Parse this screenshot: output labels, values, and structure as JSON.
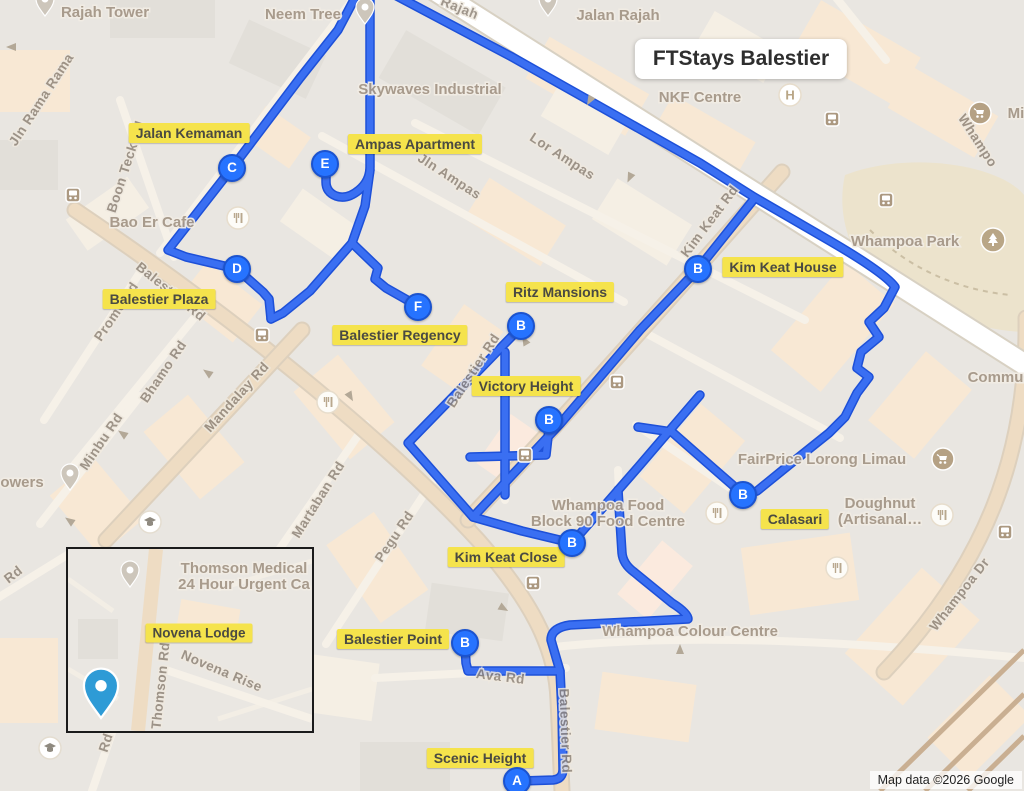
{
  "title": "FTStays Balestier",
  "attribution": "Map data ©2026 Google",
  "colors": {
    "route_core": "#3a6ff2",
    "route_casing": "#1d50d8",
    "marker_fill": "#2673ff",
    "marker_ring": "#1b53cf",
    "label_bg": "#f5e34c",
    "map_bg": "#e9e6e1"
  },
  "map": {
    "property_labels": [
      {
        "text": "Jalan Kemaman",
        "x": 189,
        "y": 133
      },
      {
        "text": "Ampas Apartment",
        "x": 415,
        "y": 144
      },
      {
        "text": "Kim Keat House",
        "x": 783,
        "y": 267
      },
      {
        "text": "Balestier Plaza",
        "x": 159,
        "y": 299
      },
      {
        "text": "Ritz Mansions",
        "x": 560,
        "y": 292
      },
      {
        "text": "Balestier Regency",
        "x": 400,
        "y": 335
      },
      {
        "text": "Victory Height",
        "x": 526,
        "y": 386
      },
      {
        "text": "Calasari",
        "x": 795,
        "y": 519
      },
      {
        "text": "Kim Keat Close",
        "x": 506,
        "y": 557
      },
      {
        "text": "Balestier Point",
        "x": 393,
        "y": 639
      },
      {
        "text": "Scenic Height",
        "x": 480,
        "y": 758
      }
    ],
    "markers": [
      {
        "letter": "C",
        "x": 232,
        "y": 168
      },
      {
        "letter": "E",
        "x": 325,
        "y": 164
      },
      {
        "letter": "D",
        "x": 237,
        "y": 269
      },
      {
        "letter": "F",
        "x": 418,
        "y": 307
      },
      {
        "letter": "B",
        "x": 521,
        "y": 326
      },
      {
        "letter": "B",
        "x": 698,
        "y": 269
      },
      {
        "letter": "B",
        "x": 549,
        "y": 420
      },
      {
        "letter": "B",
        "x": 572,
        "y": 543
      },
      {
        "letter": "B",
        "x": 743,
        "y": 495
      },
      {
        "letter": "B",
        "x": 465,
        "y": 643
      },
      {
        "letter": "A",
        "x": 517,
        "y": 781
      }
    ],
    "poi_labels": [
      {
        "lines": [
          "Rajah Tower"
        ],
        "x": 105,
        "y": 17
      },
      {
        "lines": [
          "Neem Tree"
        ],
        "x": 303,
        "y": 19
      },
      {
        "lines": [
          "Jalan Rajah"
        ],
        "x": 618,
        "y": 20
      },
      {
        "lines": [
          "Skywaves Industrial"
        ],
        "x": 430,
        "y": 94
      },
      {
        "lines": [
          "NKF Centre"
        ],
        "x": 700,
        "y": 102
      },
      {
        "lines": [
          "Whampoa Park"
        ],
        "x": 905,
        "y": 246
      },
      {
        "lines": [
          "Bao Er Cafe"
        ],
        "x": 152,
        "y": 227
      },
      {
        "lines": [
          "FairPrice Lorong Limau"
        ],
        "x": 822,
        "y": 464
      },
      {
        "lines": [
          "Doughnut",
          "(Artisanal…"
        ],
        "x": 880,
        "y": 508
      },
      {
        "lines": [
          "Whampoa Food",
          "Block 90 Food Centre"
        ],
        "x": 608,
        "y": 510
      },
      {
        "lines": [
          "Whampoa Colour Centre"
        ],
        "x": 690,
        "y": 636
      },
      {
        "lines": [
          "owers"
        ],
        "x": 22,
        "y": 487
      },
      {
        "lines": [
          "Commu…"
        ],
        "x": 1003,
        "y": 382
      },
      {
        "lines": [
          "Mi"
        ],
        "x": 1016,
        "y": 118
      }
    ],
    "street_labels": [
      {
        "text": "Jln Rama Rama",
        "x": 45,
        "y": 102,
        "rot": -57
      },
      {
        "text": "Boon Teck Rd",
        "x": 130,
        "y": 168,
        "rot": -72
      },
      {
        "text": "Rajah",
        "x": 458,
        "y": 12,
        "rot": 22
      },
      {
        "text": "Jln Ampas",
        "x": 447,
        "y": 180,
        "rot": 33
      },
      {
        "text": "Lor Ampas",
        "x": 560,
        "y": 160,
        "rot": 33
      },
      {
        "text": "Kim Keat Rd",
        "x": 713,
        "y": 224,
        "rot": -53
      },
      {
        "text": "Whampo",
        "x": 974,
        "y": 143,
        "rot": 57
      },
      {
        "text": "Balestier Rd",
        "x": 168,
        "y": 295,
        "rot": 39
      },
      {
        "text": "Balestier Rd",
        "x": 477,
        "y": 373,
        "rot": -57
      },
      {
        "text": "Balestier Rd",
        "x": 561,
        "y": 731,
        "rot": 88
      },
      {
        "text": "Bhamo Rd",
        "x": 167,
        "y": 374,
        "rot": -56
      },
      {
        "text": "Prome Rd",
        "x": 120,
        "y": 314,
        "rot": -56
      },
      {
        "text": "Mandalay Rd",
        "x": 240,
        "y": 400,
        "rot": -48
      },
      {
        "text": "Minbu Rd",
        "x": 105,
        "y": 444,
        "rot": -56
      },
      {
        "text": "Martaban Rd",
        "x": 322,
        "y": 502,
        "rot": -58
      },
      {
        "text": "Pegu Rd",
        "x": 398,
        "y": 539,
        "rot": -56
      },
      {
        "text": "Ava Rd",
        "x": 500,
        "y": 681,
        "rot": 7
      },
      {
        "text": "Whampoa Dr",
        "x": 963,
        "y": 597,
        "rot": -52
      },
      {
        "text": "Rd",
        "x": 16,
        "y": 578,
        "rot": -38
      },
      {
        "text": "Rd",
        "x": 110,
        "y": 744,
        "rot": -72
      }
    ],
    "routes": [
      "M 370 -6 L 370 167 Q 370 181 359 190 Q 347 200 336 196 Q 326 192 326 182 L 326 173",
      "M 370 170 L 365 206 L 352 243 L 310 291 L 283 313 L 271 319",
      "M 271 319 L 269 299 L 263 292 L 237 269",
      "M 237 269 L 186 257 L 168 250 L 232 168 L 300 78 L 338 30 L 357 -6",
      "M 352 243 L 378 268 L 375 279 L 386 288 L 416 305",
      "M 393 -6 L 512 57 L 700 163 L 754 197 Q 790 218 830 241 Q 885 273 895 287 L 884 308 L 869 322 L 879 337 L 861 352 L 857 368 L 869 377 L 857 393 L 845 417 L 829 433 L 789 465 L 757 491 L 744 495",
      "M 744 495 L 713 468 L 672 432 L 638 427",
      "M 698 269 L 754 199",
      "M 698 269 L 640 330 L 560 424 L 473 517 L 522 531 L 572 543",
      "M 522 326 L 408 443 L 473 517",
      "M 505 352 L 505 495",
      "M 572 543 L 640 465 L 700 395",
      "M 470 457 L 546 455 L 549 428",
      "M 618 490 L 622 553 Q 623 564 634 572 L 672 603 Q 688 613 688 619 L 570 625 Q 551 628 551 640 L 560 671",
      "M 465 645 L 466 663 L 468 671 L 560 671 L 562 712 L 563 769 Q 563 779 553 780 L 521 781"
    ],
    "icons": [
      {
        "type": "bus",
        "x": 73,
        "y": 195
      },
      {
        "type": "bus",
        "x": 262,
        "y": 335
      },
      {
        "type": "bus",
        "x": 617,
        "y": 382
      },
      {
        "type": "bus",
        "x": 525,
        "y": 455
      },
      {
        "type": "bus",
        "x": 533,
        "y": 583
      },
      {
        "type": "bus",
        "x": 886,
        "y": 200
      },
      {
        "type": "bus",
        "x": 832,
        "y": 119
      },
      {
        "type": "bus",
        "x": 1005,
        "y": 532
      },
      {
        "type": "restaurant",
        "x": 238,
        "y": 218
      },
      {
        "type": "restaurant",
        "x": 328,
        "y": 402
      },
      {
        "type": "restaurant",
        "x": 717,
        "y": 513
      },
      {
        "type": "restaurant",
        "x": 942,
        "y": 515
      },
      {
        "type": "restaurant",
        "x": 837,
        "y": 568
      },
      {
        "type": "cart",
        "x": 943,
        "y": 459
      },
      {
        "type": "cart",
        "x": 980,
        "y": 113
      },
      {
        "type": "tree",
        "x": 993,
        "y": 240
      },
      {
        "type": "hospital",
        "x": 790,
        "y": 95
      },
      {
        "type": "school",
        "x": 150,
        "y": 522
      },
      {
        "type": "school",
        "x": 50,
        "y": 748
      },
      {
        "type": "pin",
        "x": 45,
        "y": 6
      },
      {
        "type": "pin",
        "x": 365,
        "y": 14
      },
      {
        "type": "pin",
        "x": 548,
        "y": 6
      },
      {
        "type": "pin",
        "x": 70,
        "y": 480
      },
      {
        "type": "arrow",
        "x": 590,
        "y": 100,
        "rot": 120
      },
      {
        "type": "arrow",
        "x": 630,
        "y": 177,
        "rot": 115
      },
      {
        "type": "arrow",
        "x": 525,
        "y": 341,
        "rot": 240
      },
      {
        "type": "arrow",
        "x": 350,
        "y": 396,
        "rot": 60
      },
      {
        "type": "arrow",
        "x": 208,
        "y": 373,
        "rot": 215
      },
      {
        "type": "arrow",
        "x": 123,
        "y": 434,
        "rot": 215
      },
      {
        "type": "arrow",
        "x": 503,
        "y": 608,
        "rot": 30
      },
      {
        "type": "arrow",
        "x": 12,
        "y": 47,
        "rot": 180
      },
      {
        "type": "arrow",
        "x": 70,
        "y": 521,
        "rot": 215
      },
      {
        "type": "arrow",
        "x": 680,
        "y": 650,
        "rot": 270
      }
    ],
    "inset": {
      "x": 66,
      "y": 547,
      "w": 244,
      "h": 182,
      "property_label": {
        "text": "Novena Lodge",
        "x": 131,
        "y": 84
      },
      "poi": {
        "lines": [
          "Thomson Medical",
          "24 Hour Urgent Ca"
        ],
        "x": 176,
        "y": 24
      },
      "poi_pin": {
        "x": 62,
        "y": 28
      },
      "street_labels": [
        {
          "text": "Thomson Rd",
          "x": 97,
          "y": 137,
          "rot": -84
        },
        {
          "text": "Novena Rise",
          "x": 152,
          "y": 126,
          "rot": 23
        }
      ],
      "blue_pin": {
        "x": 33,
        "y": 150
      }
    }
  }
}
